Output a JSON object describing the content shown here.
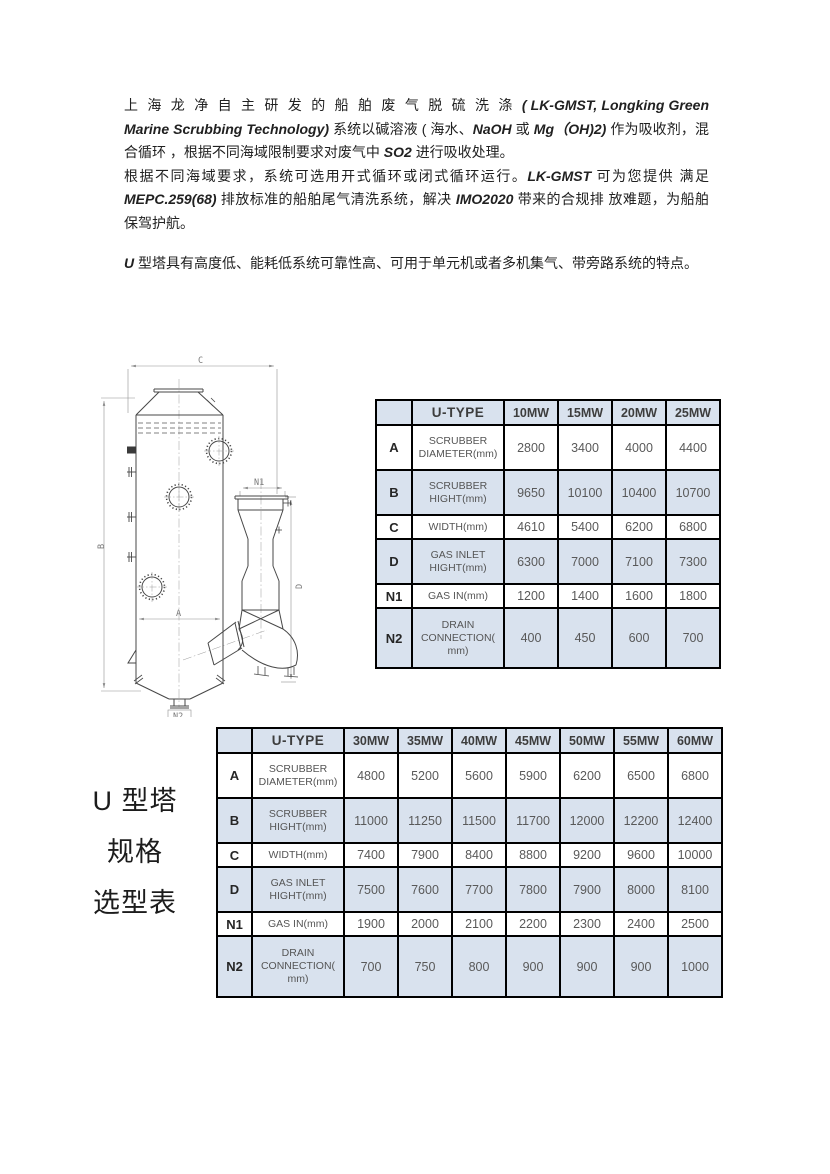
{
  "page": {
    "background": "#ffffff"
  },
  "colors": {
    "table_shade": "#d9e2ee",
    "table_border": "#000000",
    "body_text": "#212121",
    "table_text": "#595959"
  },
  "intro": {
    "paragraphs": [
      [
        {
          "t": "上 海 龙 净 自 主 研 发 的 船 舶 废 气 脱 硫 洗 涤 ",
          "lat": false,
          "wide": true
        },
        {
          "t": "( LK-GMST, Longking Green Marine Scrubbing Technology) ",
          "lat": true
        },
        {
          "t": "系统以碱溶液 ( 海水、",
          "lat": false
        },
        {
          "t": "NaOH ",
          "lat": true
        },
        {
          "t": "或 ",
          "lat": false
        },
        {
          "t": "Mg（OH)2) ",
          "lat": true
        },
        {
          "t": "作为吸收剂，混合循环 ，根据不同海域限制要求对废气中 ",
          "lat": false
        },
        {
          "t": "SO2 ",
          "lat": true
        },
        {
          "t": "进行吸收处理。",
          "lat": false
        }
      ],
      [
        {
          "t": "根据不同海域要求，系统可选用开式循环或闭式循环运行。",
          "lat": false
        },
        {
          "t": "LK-GMST ",
          "lat": true
        },
        {
          "t": "可为您提供 满足 ",
          "lat": false
        },
        {
          "t": "MEPC.259(68) ",
          "lat": true
        },
        {
          "t": "排放标准的船舶尾气清洗系统，解决 ",
          "lat": false
        },
        {
          "t": "IMO2020 ",
          "lat": true
        },
        {
          "t": "带来的合规排 放难题，为船舶保驾护航。",
          "lat": false
        }
      ],
      [
        {
          "t": "U ",
          "lat": true
        },
        {
          "t": "型塔具有高度低、能耗低系统可靠性高、可用于单元机或者多机集气、带旁路系统的特点。",
          "lat": false
        }
      ]
    ]
  },
  "side_label": {
    "lines": [
      "U 型塔",
      "规格",
      "选型表"
    ]
  },
  "diagram": {
    "labels": {
      "overall_width": "C",
      "overall_height": "B",
      "scrubber_diameter": "A",
      "gas_inlet_height": "D",
      "gas_in": "N1",
      "drain": "N2"
    }
  },
  "tables": [
    {
      "title": "U-TYPE",
      "corner": "",
      "columns": [
        "10MW",
        "15MW",
        "20MW",
        "25MW"
      ],
      "rows": [
        {
          "key": "A",
          "name": "SCRUBBER DIAMETER(mm)",
          "name_lines": [
            "SCRUBBER",
            "DIAMETER(mm)"
          ],
          "values": [
            "2800",
            "3400",
            "4000",
            "4400"
          ]
        },
        {
          "key": "B",
          "name": "SCRUBBER HIGHT(mm)",
          "name_lines": [
            "SCRUBBER",
            "HIGHT(mm)"
          ],
          "values": [
            "9650",
            "10100",
            "10400",
            "10700"
          ]
        },
        {
          "key": "C",
          "name": "WIDTH(mm)",
          "name_lines": [
            "WIDTH(mm)"
          ],
          "values": [
            "4610",
            "5400",
            "6200",
            "6800"
          ]
        },
        {
          "key": "D",
          "name": "GAS INLET HIGHT(mm)",
          "name_lines": [
            "GAS INLET",
            "HIGHT(mm)"
          ],
          "values": [
            "6300",
            "7000",
            "7100",
            "7300"
          ]
        },
        {
          "key": "N1",
          "name": "GAS IN(mm)",
          "name_lines": [
            "GAS IN(mm)"
          ],
          "values": [
            "1200",
            "1400",
            "1600",
            "1800"
          ]
        },
        {
          "key": "N2",
          "name": "DRAIN CONNECTION(mm)",
          "name_lines": [
            "DRAIN",
            "CONNECTION(",
            "mm)"
          ],
          "values": [
            "400",
            "450",
            "600",
            "700"
          ]
        }
      ]
    },
    {
      "title": "U-TYPE",
      "corner": "",
      "columns": [
        "30MW",
        "35MW",
        "40MW",
        "45MW",
        "50MW",
        "55MW",
        "60MW"
      ],
      "rows": [
        {
          "key": "A",
          "name": "SCRUBBER DIAMETER(mm)",
          "name_lines": [
            "SCRUBBER",
            "DIAMETER(mm)"
          ],
          "values": [
            "4800",
            "5200",
            "5600",
            "5900",
            "6200",
            "6500",
            "6800"
          ]
        },
        {
          "key": "B",
          "name": "SCRUBBER HIGHT(mm)",
          "name_lines": [
            "SCRUBBER",
            "HIGHT(mm)"
          ],
          "values": [
            "11000",
            "11250",
            "11500",
            "11700",
            "12000",
            "12200",
            "12400"
          ]
        },
        {
          "key": "C",
          "name": "WIDTH(mm)",
          "name_lines": [
            "WIDTH(mm)"
          ],
          "values": [
            "7400",
            "7900",
            "8400",
            "8800",
            "9200",
            "9600",
            "10000"
          ]
        },
        {
          "key": "D",
          "name": "GAS INLET HIGHT(mm)",
          "name_lines": [
            "GAS INLET",
            "HIGHT(mm)"
          ],
          "values": [
            "7500",
            "7600",
            "7700",
            "7800",
            "7900",
            "8000",
            "8100"
          ]
        },
        {
          "key": "N1",
          "name": "GAS IN(mm)",
          "name_lines": [
            "GAS IN(mm)"
          ],
          "values": [
            "1900",
            "2000",
            "2100",
            "2200",
            "2300",
            "2400",
            "2500"
          ]
        },
        {
          "key": "N2",
          "name": "DRAIN CONNECTION(mm)",
          "name_lines": [
            "DRAIN",
            "CONNECTION(",
            "mm)"
          ],
          "values": [
            "700",
            "750",
            "800",
            "900",
            "900",
            "900",
            "1000"
          ]
        }
      ]
    }
  ]
}
